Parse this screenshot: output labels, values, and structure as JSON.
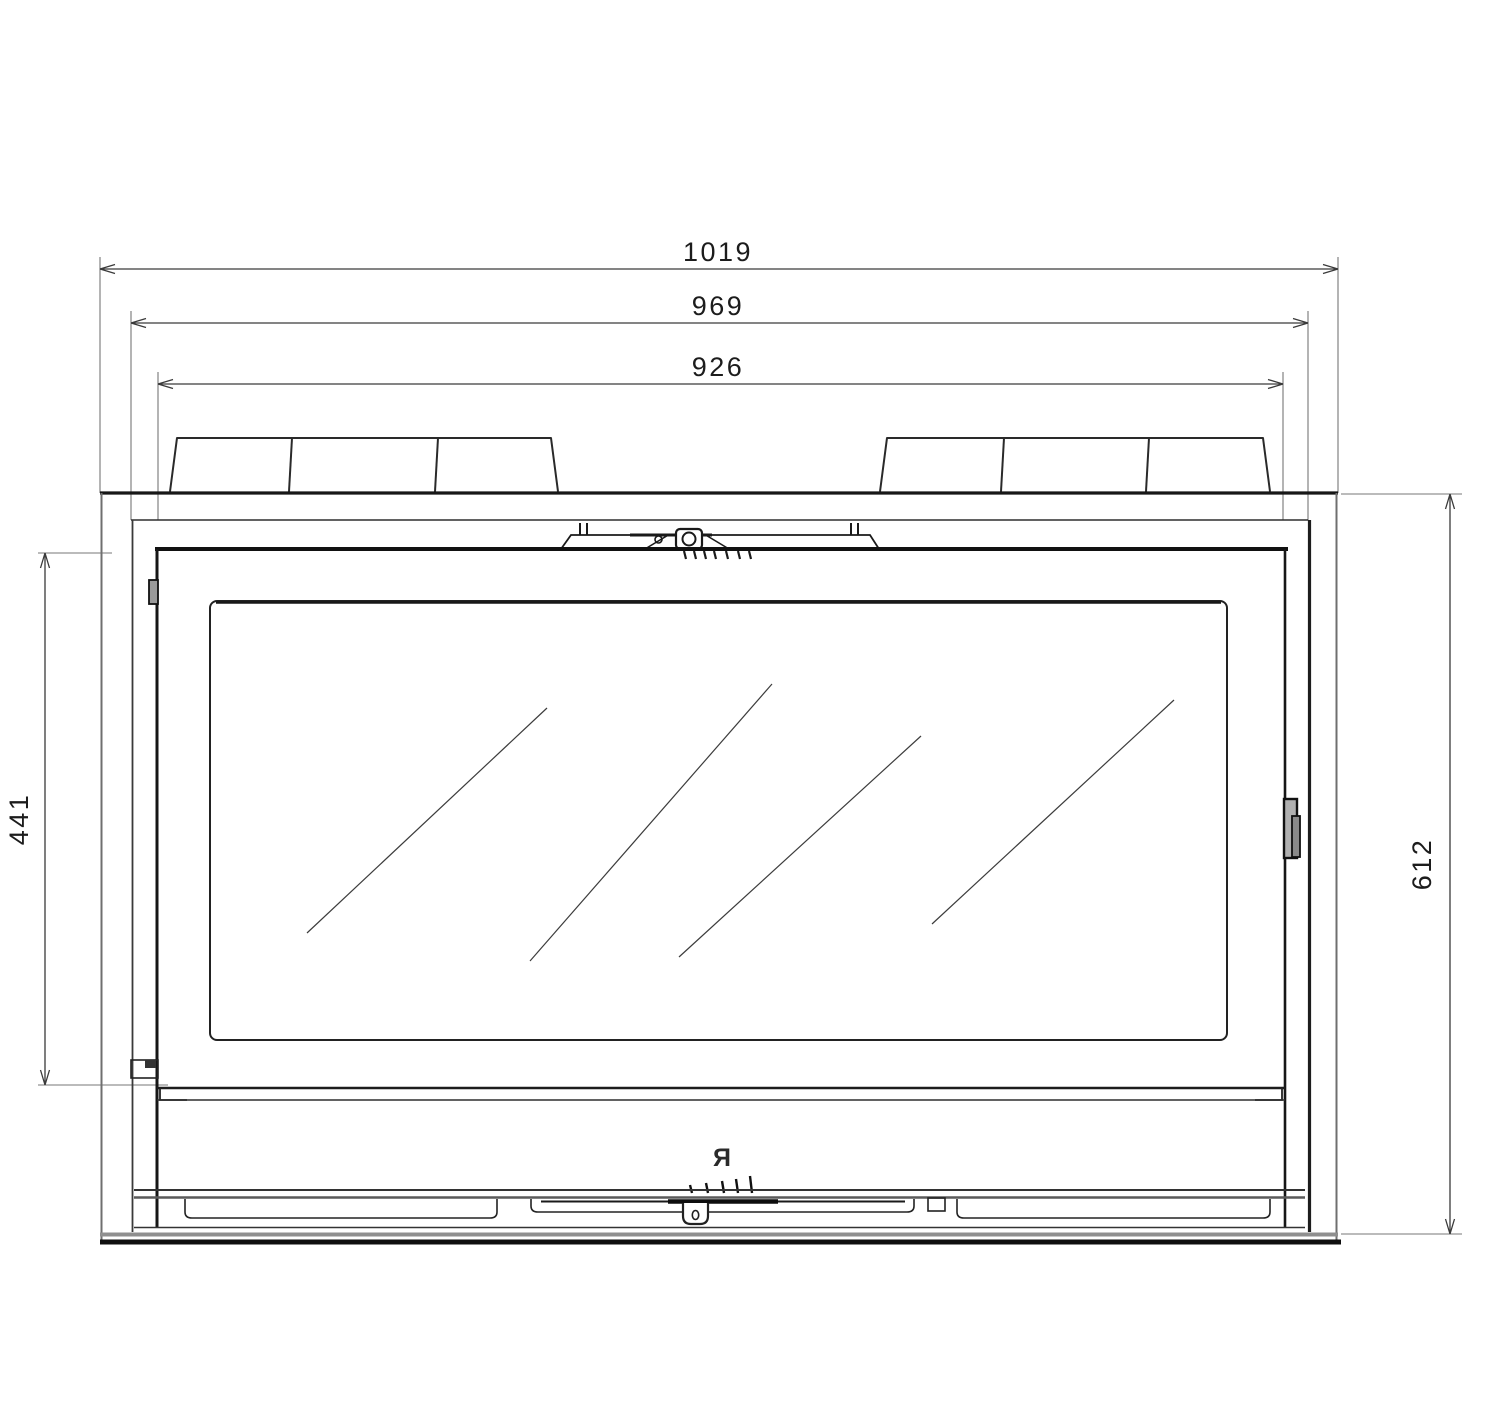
{
  "colors": {
    "background": "#ffffff",
    "primary_line": "#1c1c1c",
    "secondary_line": "#6f6f6f",
    "accent_fill": "#9a9a9a"
  },
  "dimensions": {
    "horizontal": [
      {
        "id": "overall-width",
        "label": "1019"
      },
      {
        "id": "frame-width",
        "label": "969"
      },
      {
        "id": "firebox-width",
        "label": "926"
      }
    ],
    "vertical": [
      {
        "id": "door-height",
        "label": "441"
      },
      {
        "id": "overall-height",
        "label": "612"
      }
    ]
  },
  "logo": {
    "text": "Я"
  }
}
